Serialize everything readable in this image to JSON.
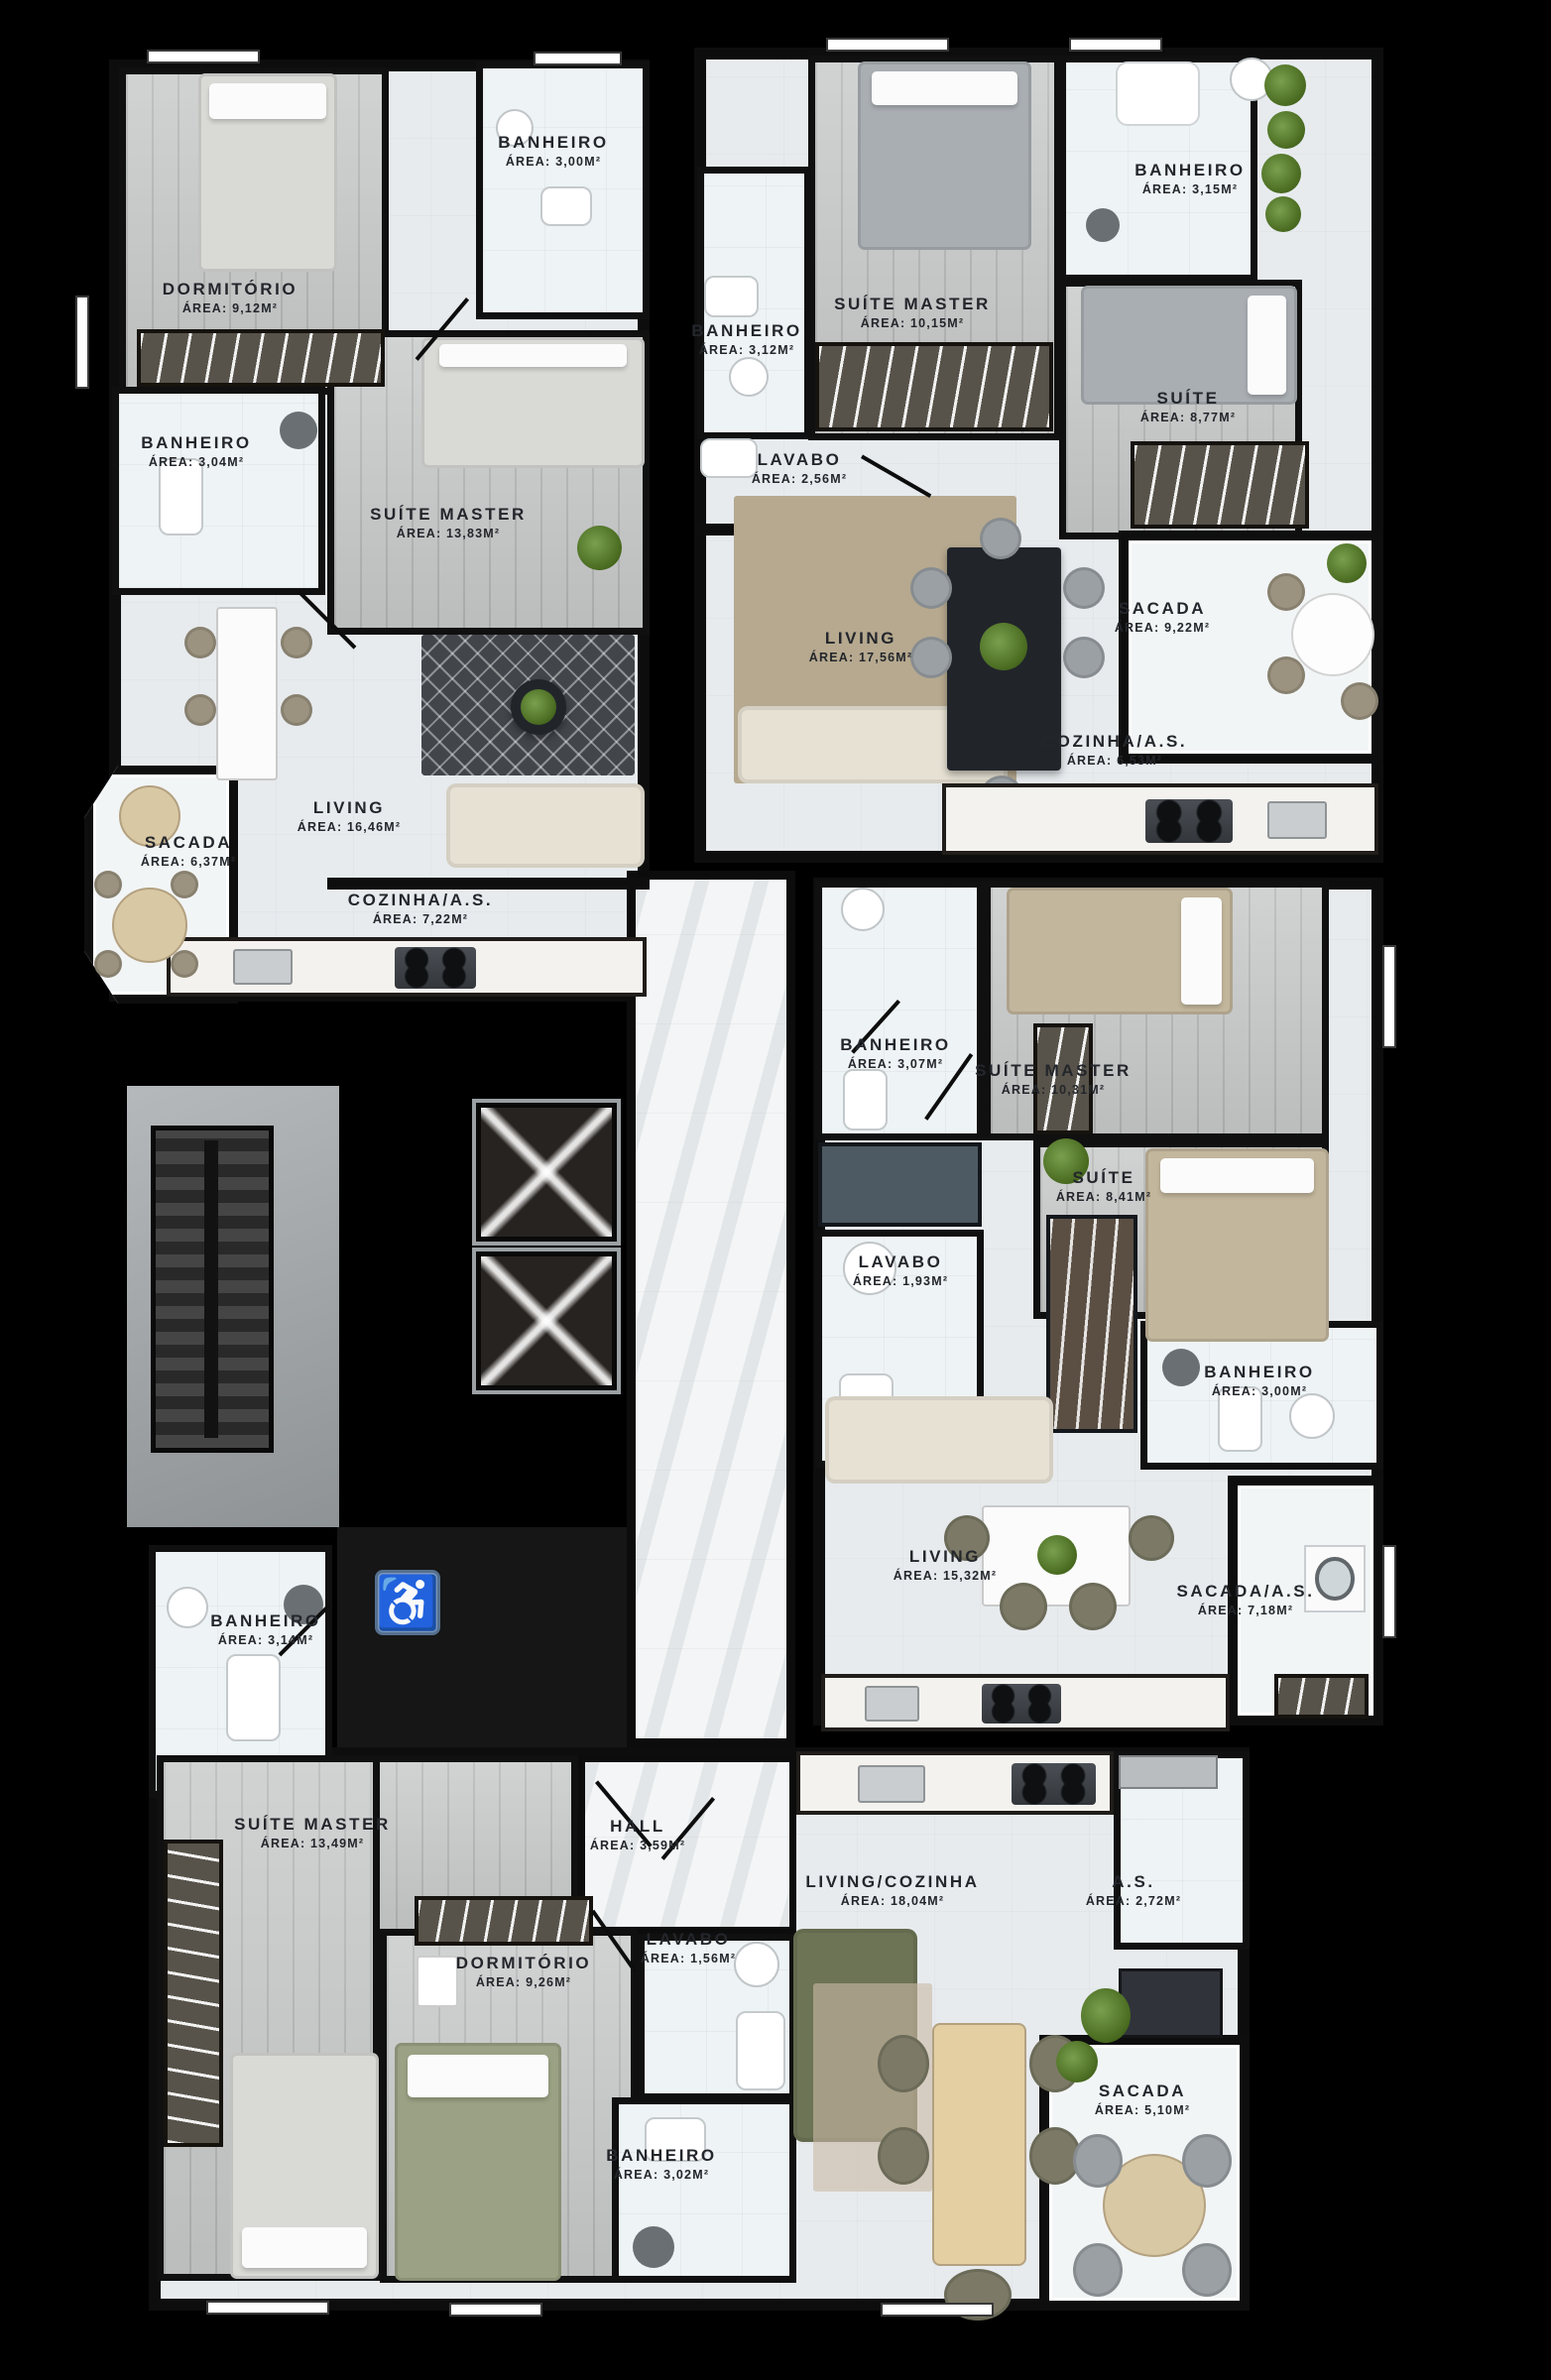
{
  "floorplan": {
    "accessibility_icon": "♿",
    "colors": {
      "wall": "#0d0d0d",
      "floor_tile": "#eef3f5",
      "wood_floor": "#c7c9c9",
      "accessibility_blue": "#7b96bd",
      "plant_green": "#48691f",
      "rug_beige": "#b6a98f",
      "sofa_olive": "#6d7355"
    },
    "units": [
      {
        "id": "apartment-top-left",
        "rooms": [
          {
            "name": "Banheiro",
            "area": "Área: 3,00m²"
          },
          {
            "name": "Dormitório",
            "area": "Área: 9,12m²"
          },
          {
            "name": "Banheiro",
            "area": "Área: 3,04m²"
          },
          {
            "name": "Suíte Master",
            "area": "Área: 13,83m²"
          },
          {
            "name": "Living",
            "area": "Área: 16,46m²"
          },
          {
            "name": "Sacada",
            "area": "Área: 6,37m²"
          },
          {
            "name": "Cozinha/A.S.",
            "area": "Área: 7,22m²"
          }
        ]
      },
      {
        "id": "apartment-top-right",
        "rooms": [
          {
            "name": "Banheiro",
            "area": "Área: 3,15m²"
          },
          {
            "name": "Suíte Master",
            "area": "Área: 10,15m²"
          },
          {
            "name": "Banheiro",
            "area": "Área: 3,12m²"
          },
          {
            "name": "Suíte",
            "area": "Área: 8,77m²"
          },
          {
            "name": "Lavabo",
            "area": "Área: 2,56m²"
          },
          {
            "name": "Living",
            "area": "Área: 17,56m²"
          },
          {
            "name": "Sacada",
            "area": "Área: 9,22m²"
          },
          {
            "name": "Cozinha/A.S.",
            "area": "Área: 6,53m²"
          }
        ]
      },
      {
        "id": "apartment-middle-right",
        "rooms": [
          {
            "name": "Banheiro",
            "area": "Área: 3,07m²"
          },
          {
            "name": "Suíte Master",
            "area": "Área: 10,31m²"
          },
          {
            "name": "Suíte",
            "area": "Área: 8,41m²"
          },
          {
            "name": "Lavabo",
            "area": "Área: 1,93m²"
          },
          {
            "name": "Banheiro",
            "area": "Área: 3,00m²"
          },
          {
            "name": "Living",
            "area": "Área: 15,32m²"
          },
          {
            "name": "Sacada/A.S.",
            "area": "Área: 7,18m²"
          }
        ]
      },
      {
        "id": "common-area",
        "rooms": [
          {
            "name": "Banheiro",
            "area": "Área: 3,14m²"
          }
        ]
      },
      {
        "id": "apartment-bottom",
        "rooms": [
          {
            "name": "Suíte Master",
            "area": "Área: 13,49m²"
          },
          {
            "name": "Hall",
            "area": "Área: 3,59m²"
          },
          {
            "name": "Dormitório",
            "area": "Área: 9,26m²"
          },
          {
            "name": "Lavabo",
            "area": "Área: 1,56m²"
          },
          {
            "name": "Living/Cozinha",
            "area": "Área: 18,04m²"
          },
          {
            "name": "A.S.",
            "area": "Área: 2,72m²"
          },
          {
            "name": "Banheiro",
            "area": "Área: 3,02m²"
          },
          {
            "name": "Sacada",
            "area": "Área: 5,10m²"
          }
        ]
      }
    ]
  }
}
